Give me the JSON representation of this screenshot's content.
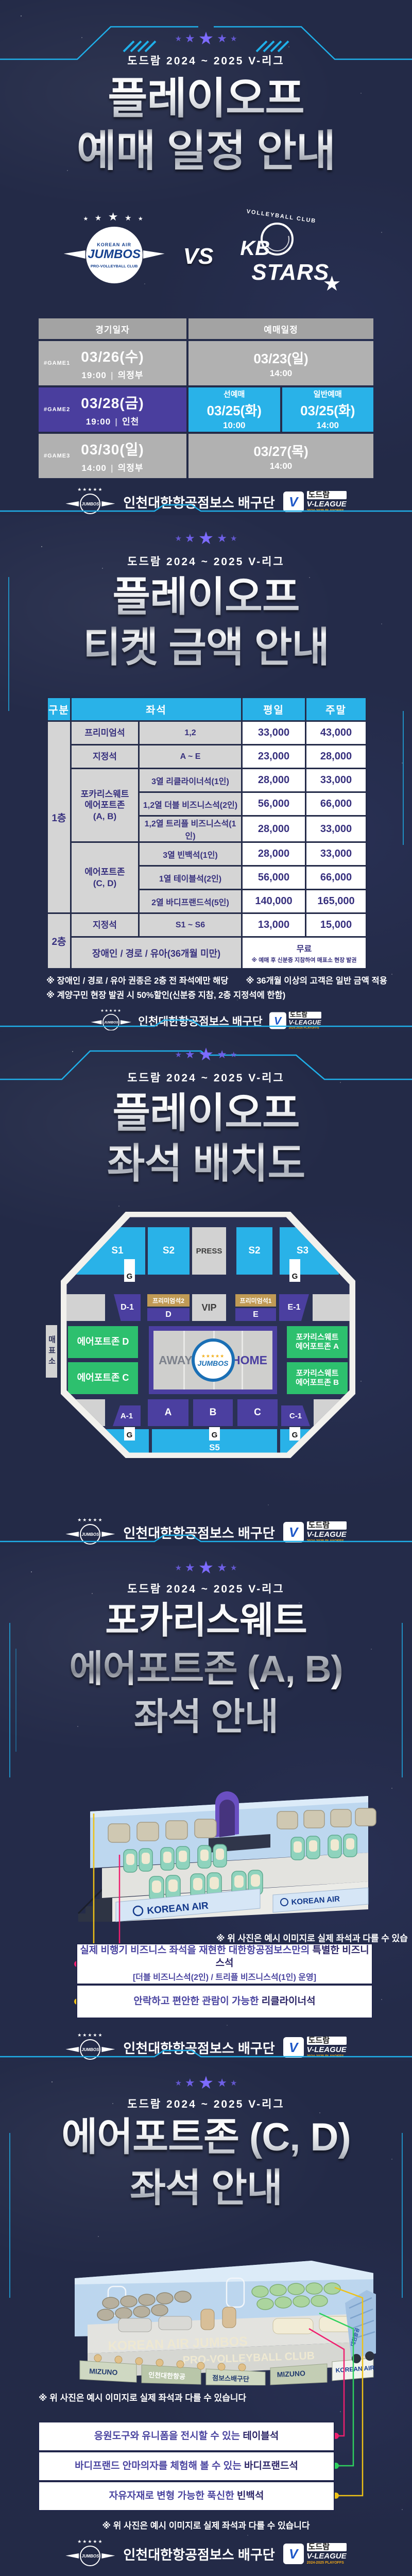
{
  "league_subtitle": "도드람 2024 ~ 2025 V-리그",
  "icons": {
    "star": "★",
    "stars5": "★★★★★",
    "note": "※"
  },
  "footer": {
    "team_name": "인천대한항공점보스 배구단",
    "jumbos_logo": "JUMBOS",
    "vleague": {
      "v": "V",
      "dodram": "도드람",
      "league": "V-LEAGUE",
      "sub": "2024-2025 PLAYOFFS"
    }
  },
  "schedule": {
    "title_line1": "플레이오프",
    "title_line2": "예매 일정 안내",
    "matchup": {
      "home_logo": {
        "top": "KOREAN AIR",
        "name": "JUMBOS",
        "bottom": "PRO-VOLLEYBALL CLUB"
      },
      "vs": "VS",
      "away_logo": {
        "top": "VOLLEYBALL CLUB",
        "name1": "KB",
        "name2": "STARS"
      }
    },
    "table": {
      "col_game": "경기일자",
      "col_booking": "예매일정",
      "divider": "|",
      "rows": [
        {
          "game": "#GAME1",
          "date": "03/26(수)",
          "time": "19:00",
          "venue": "의정부",
          "bookings": [
            {
              "label": "",
              "date": "03/23(일)",
              "time": "14:00"
            }
          ]
        },
        {
          "game": "#GAME2",
          "date": "03/28(금)",
          "time": "19:00",
          "venue": "인천",
          "bookings": [
            {
              "label": "선예매",
              "date": "03/25(화)",
              "time": "10:00"
            },
            {
              "label": "일반예매",
              "date": "03/25(화)",
              "time": "14:00"
            }
          ]
        },
        {
          "game": "#GAME3",
          "date": "03/30(일)",
          "time": "14:00",
          "venue": "의정부",
          "bookings": [
            {
              "label": "",
              "date": "03/27(목)",
              "time": "14:00"
            }
          ]
        }
      ]
    }
  },
  "pricing": {
    "title_line1": "플레이오프",
    "title_line2": "티켓 금액 안내",
    "table": {
      "headers": {
        "zone": "구분",
        "seat": "좌석",
        "weekday": "평일",
        "weekend": "주말"
      },
      "floor1_label": "1층",
      "rows_simple": [
        {
          "name": "프리미엄석",
          "detail": "1,2",
          "weekday": "33,000",
          "weekend": "43,000"
        },
        {
          "name": "지정석",
          "detail": "A ~ E",
          "weekday": "23,000",
          "weekend": "28,000"
        }
      ],
      "group_ab": {
        "name_line1": "포카리스웨트",
        "name_line2": "에어포트존",
        "name_line3": "(A, B)",
        "rows": [
          {
            "detail": "3열 리클라이너석(1인)",
            "weekday": "28,000",
            "weekend": "33,000"
          },
          {
            "detail": "1,2열 더블 비즈니스석(2인)",
            "weekday": "56,000",
            "weekend": "66,000"
          },
          {
            "detail": "1,2열 트리플 비즈니스석(1인)",
            "weekday": "28,000",
            "weekend": "33,000"
          }
        ]
      },
      "group_cd": {
        "name_line1": "에어포트존",
        "name_line2": "(C, D)",
        "rows": [
          {
            "detail": "3열 빈백석(1인)",
            "weekday": "28,000",
            "weekend": "33,000"
          },
          {
            "detail": "1열 테이블석(2인)",
            "weekday": "56,000",
            "weekend": "66,000"
          },
          {
            "detail": "2열 바디프랜드석(5인)",
            "weekday": "140,000",
            "weekend": "165,000"
          }
        ]
      },
      "floor2_label": "2층",
      "floor2_row": {
        "name": "지정석",
        "detail": "S1 ~ S6",
        "weekday": "13,000",
        "weekend": "15,000"
      },
      "free_row": {
        "label": "장애인 / 경로 / 유아(36개월 미만)",
        "price": "무료",
        "note": "※ 예매 후 신분증 지참하여 매표소 현장 발권"
      }
    },
    "notes": [
      "※ 장애인 / 경로 / 유아 권종은 2층 전 좌석에만 해당",
      "※ 36개월 이상의 고객은 일반 금액 적용",
      "※ 계양구민 현장 발권 시 50%할인(신분증 지참, 2층 지정석에 한함)"
    ]
  },
  "seatmap": {
    "title_line1": "플레이오프",
    "title_line2": "좌석 배치도",
    "ticket_office": "매표소",
    "g": "G",
    "top_sections": [
      "S1",
      "S2",
      "PRESS",
      "S2",
      "S3"
    ],
    "mid": {
      "d1": "D-1",
      "prem2": "프리미엄석2",
      "d": "D",
      "vip": "VIP",
      "prem1": "프리미엄석1",
      "e": "E",
      "e1": "E-1"
    },
    "left_zones": [
      "에어포트존 D",
      "에어포트존 C"
    ],
    "right_zone_a": {
      "line1": "포카리스웨트",
      "line2": "에어포트존 A"
    },
    "right_zone_b": {
      "line1": "포카리스웨트",
      "line2": "에어포트존 B"
    },
    "court": {
      "away": "AWAY",
      "home": "HOME",
      "logo": "JUMBOS"
    },
    "bottom_purple": [
      "A-1",
      "A",
      "B",
      "C",
      "C-1"
    ],
    "bottom_sections": [
      "S6",
      "S5",
      "S4"
    ]
  },
  "zone_ab": {
    "title_line1": "포카리스웨트",
    "title_line2": "에어포트존 (A, B)",
    "title_line3": "좌석 안내",
    "render": {
      "banner": "KOREAN AIR"
    },
    "caption": "※ 위 사진은 예시 이미지로 실제 좌석과 다를 수 있습니다",
    "callout1": {
      "pre": "실제 비행기 비즈니스 좌석을 재현한 대한항공점보스만의 ",
      "bold": "특별한 비즈니스석",
      "sub": "[더블 비즈니스석(2인) / 트리플 비즈니스석(1인) 운영]"
    },
    "callout2": {
      "pre": "안락하고 편안한 관람이 가능한 ",
      "bold": "리클라이너석"
    }
  },
  "zone_cd": {
    "title_line1": "에어포트존 (C, D)",
    "title_line2": "좌석 안내",
    "render": {
      "wall1": "KOREAN AIR JUMBOS",
      "wall2": "PRO-VOLLEYBALL CLUB",
      "banner_mizuno": "MIZUNO",
      "banner_airline": "인천대한항공",
      "banner_team": "점보스배구단",
      "banner_korean_air": "KOREAN AIR",
      "stair_text": "대한항공"
    },
    "caption": "※ 위 사진은 예시 이미지로 실제 좌석과 다를 수 있습니다",
    "callout1": {
      "pre": "응원도구와 유니폼을 전시할 수 있는 ",
      "bold": "테이블석"
    },
    "callout2": {
      "pre": "바디프랜드 안마의자를 체험해 볼 수 있는 ",
      "bold": "바디프랜드석"
    },
    "callout3": {
      "pre": "자유자재로 변형 가능한 푹신한 ",
      "bold": "빈백석"
    }
  }
}
